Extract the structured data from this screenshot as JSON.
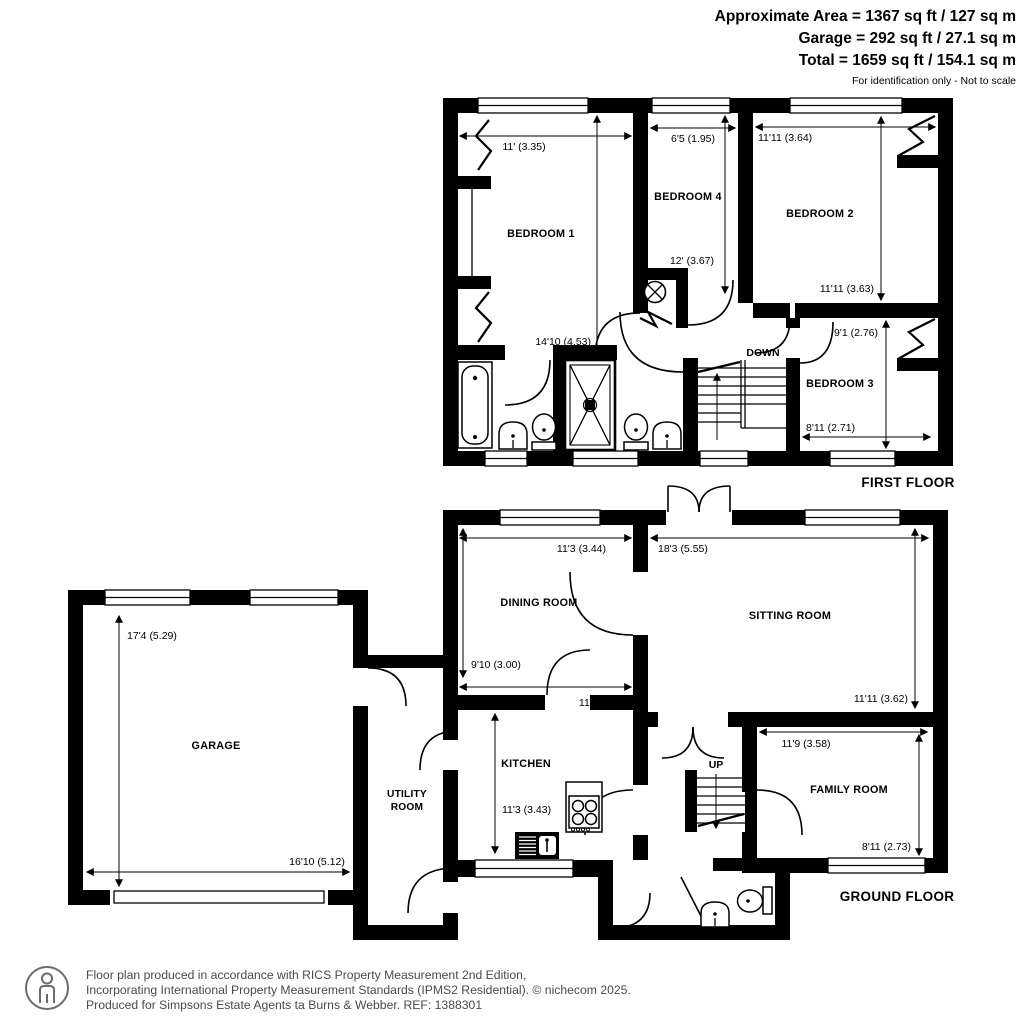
{
  "header": {
    "line1": "Approximate Area = 1367 sq ft / 127 sq m",
    "line2": "Garage = 292 sq ft / 27.1 sq m",
    "line3": "Total = 1659 sq ft / 154.1 sq m",
    "disclaimer": "For identification only - Not to scale"
  },
  "first_floor": {
    "title": "FIRST FLOOR",
    "stairs_label": "DOWN",
    "bedroom1": {
      "name": "BEDROOM 1",
      "width": "11' (3.35)",
      "depth": "14'10 (4.53)"
    },
    "bedroom4": {
      "name": "BEDROOM 4",
      "width": "6'5 (1.95)",
      "depth": "12' (3.67)"
    },
    "bedroom2": {
      "name": "BEDROOM 2",
      "width": "11'11 (3.64)",
      "depth": "11'11 (3.63)"
    },
    "bedroom3": {
      "name": "BEDROOM 3",
      "width": "8'11 (2.71)",
      "depth": "9'1 (2.76)"
    }
  },
  "ground_floor": {
    "title": "GROUND FLOOR",
    "stairs_label": "UP",
    "dining": {
      "name": "DINING ROOM",
      "width": "11'3 (3.44)",
      "depth": "9'10 (3.00)"
    },
    "sitting": {
      "name": "SITTING ROOM",
      "width": "18'3 (5.55)",
      "depth": "11'11 (3.62)"
    },
    "kitchen": {
      "name": "KITCHEN",
      "width": "11'3 (3.44)",
      "depth": "11'3 (3.43)"
    },
    "utility": {
      "line1": "UTILITY",
      "line2": "ROOM"
    },
    "family": {
      "name": "FAMILY ROOM",
      "width": "11'9 (3.58)",
      "depth": "8'11 (2.73)"
    },
    "garage": {
      "name": "GARAGE",
      "width": "16'10 (5.12)",
      "depth": "17'4 (5.29)"
    }
  },
  "footer": {
    "line1": "Floor plan produced in accordance with RICS Property Measurement 2nd Edition,",
    "line2": "Incorporating International Property Measurement Standards (IPMS2 Residential).   © nichecom 2025.",
    "line3": "Produced for Simpsons Estate Agents ta Burns & Webber.   REF:  1388301"
  }
}
